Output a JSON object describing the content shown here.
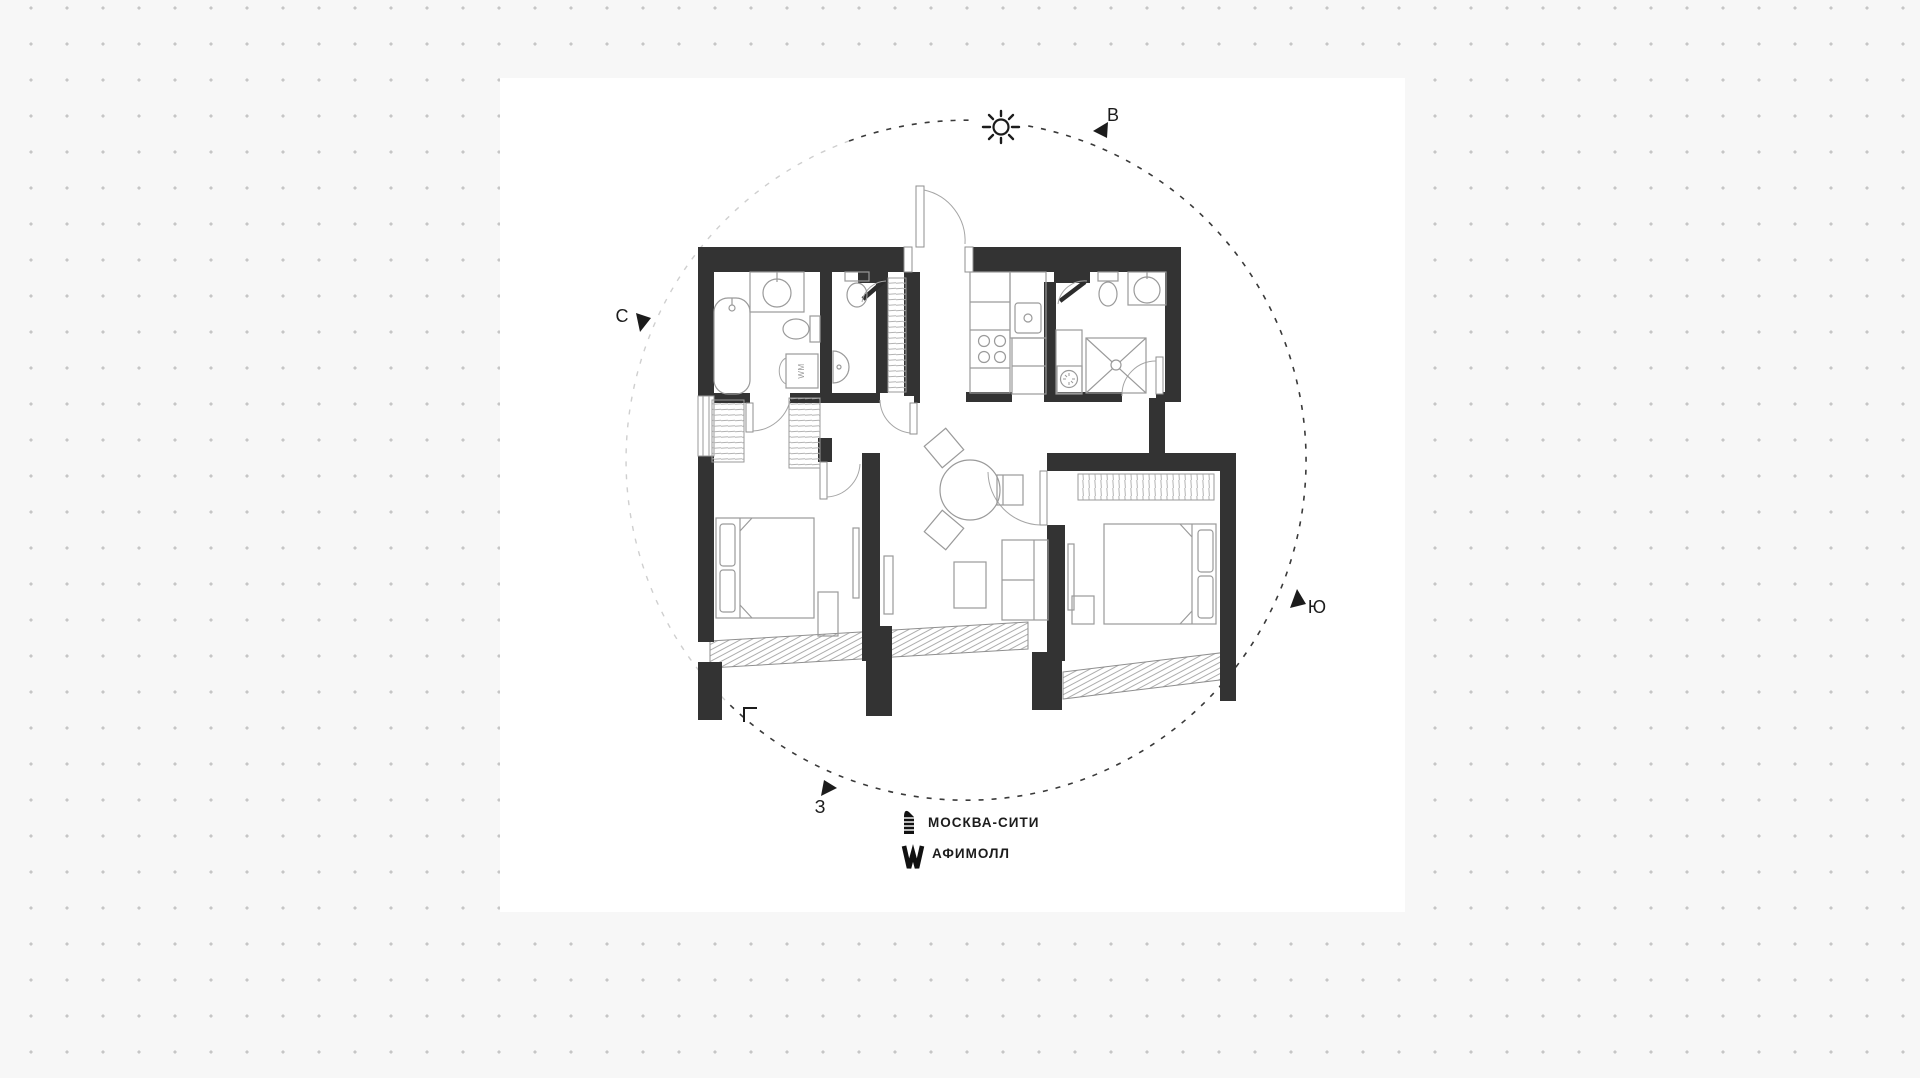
{
  "compass": {
    "north": "С",
    "east": "В",
    "south": "Ю",
    "west": "З"
  },
  "legend": {
    "items": [
      {
        "id": "moscow-city",
        "icon": "moscow-city-tower-icon",
        "label": "МОСКВА-СИТИ"
      },
      {
        "id": "afimall",
        "icon": "afimall-w-icon",
        "label": "АФИМОЛЛ"
      }
    ]
  },
  "plan": {
    "appliance_labels": {
      "washing_machine": "WM"
    }
  },
  "colors": {
    "background": "#f7f7f7",
    "dots": "#c6c6c6",
    "paper": "#ffffff",
    "wall": "#333333",
    "fixture": "#9a9a9a",
    "hatch": "#b3b3b3",
    "circle_dark": "#3a3a3a",
    "circle_light": "#cfcfcf",
    "ink": "#1c1c1c"
  }
}
